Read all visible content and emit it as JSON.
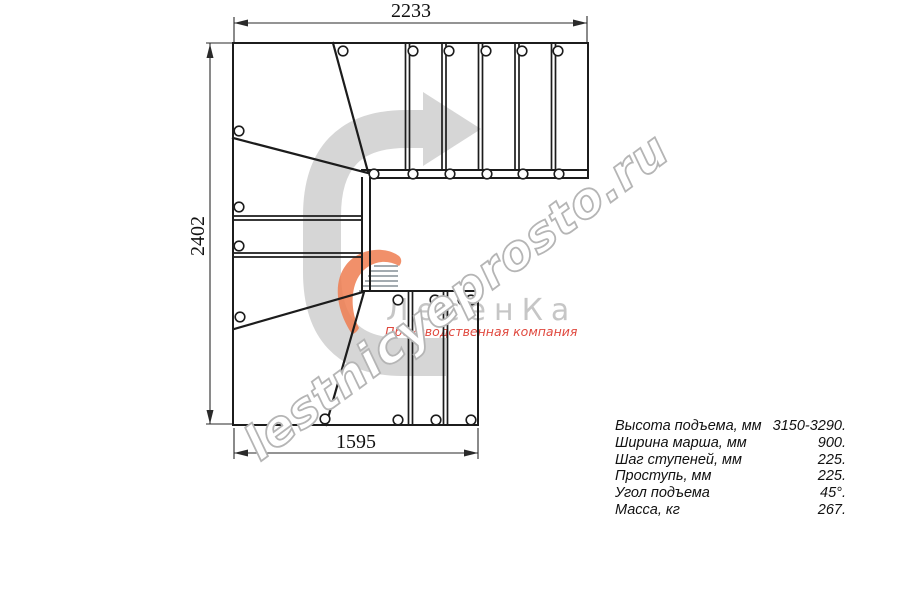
{
  "drawing": {
    "dimensions": {
      "top": "2233",
      "left": "2402",
      "bottom": "1595"
    },
    "watermark": "lestnicyeprosto.ru",
    "logo": {
      "name": "ЛесенКа",
      "tagline": "Производственная компания"
    },
    "colors": {
      "line": "#1c1c1c",
      "dimension_line": "#2a2a2a",
      "arrow_gray": "#d6d6d6",
      "watermark_outline": "#b5b5b5",
      "logo_orange": "#ef7c50",
      "logo_red": "#e0493f",
      "logo_gray": "#c6c6c6"
    }
  },
  "specs": {
    "rows": [
      {
        "label": "Высота подъема, мм",
        "value": "3150-3290."
      },
      {
        "label": "Ширина марша, мм",
        "value": "900."
      },
      {
        "label": "Шаг ступеней, мм",
        "value": "225."
      },
      {
        "label": "Проступь, мм",
        "value": "225."
      },
      {
        "label": "Угол подъема",
        "value": "45°."
      },
      {
        "label": "Масса, кг",
        "value": "267."
      }
    ]
  }
}
